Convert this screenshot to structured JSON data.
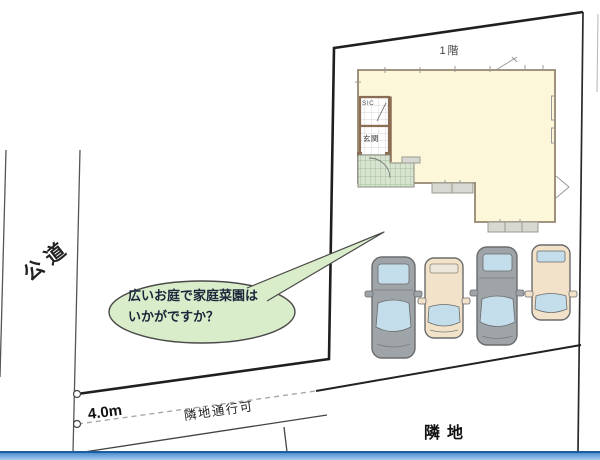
{
  "labels": {
    "floor": "1階",
    "road": "公道",
    "frontage": "4.0m",
    "passage": "隣地通行可",
    "neighbor": "隣地",
    "shoe_closet": "SIC",
    "entrance": "玄関"
  },
  "callout": {
    "line1": "広いお庭で家庭菜園は",
    "line2": "いかがですか？"
  },
  "cars": [
    {
      "body": "gray"
    },
    {
      "body": "beige"
    },
    {
      "body": "gray"
    },
    {
      "body": "beige"
    }
  ],
  "colors": {
    "boundary": "#1f1f1f",
    "dashed": "#a8a8a8",
    "house_fill": "#fcf7d8",
    "wall": "#94856f",
    "wall_entrance": "#8a6d52",
    "step": "#d8d8d2",
    "car_gray": "#9fa4a8",
    "car_beige": "#f2e2c9",
    "glass": "#c4ddeb",
    "glass_pale": "#ece7da",
    "bubble": "#daedca",
    "bubble_stroke": "#4a4a4a",
    "text_dark": "#19273a",
    "bar_dark": "#1f5c9e",
    "bar_mid": "#4e90d0",
    "bar_light": "#a6cdee"
  }
}
